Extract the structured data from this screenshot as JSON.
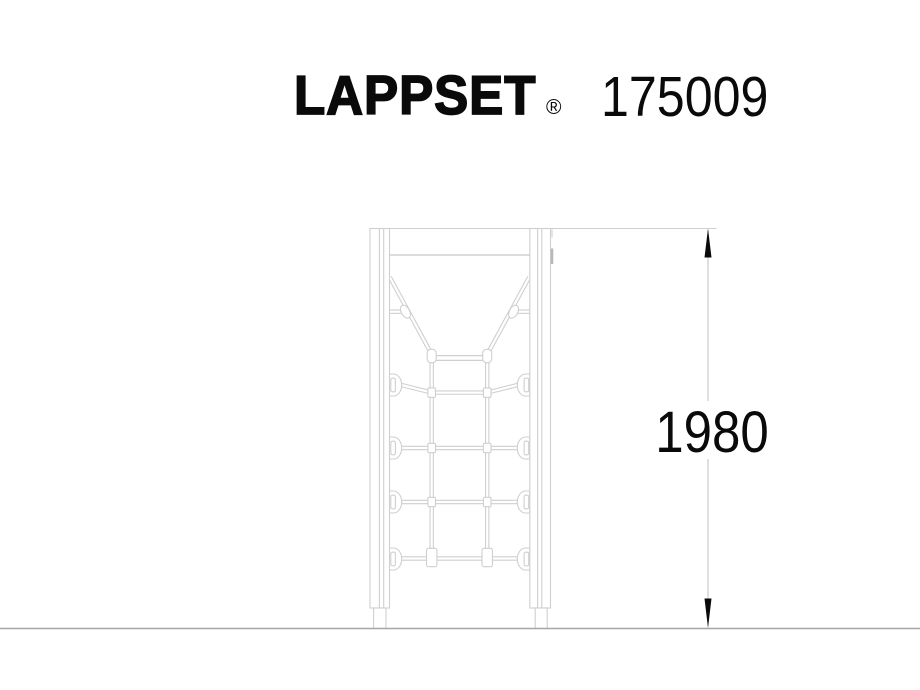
{
  "header": {
    "brand": "LAPPSET",
    "registered_mark": "®",
    "product_code": "175009"
  },
  "drawing": {
    "dimension": {
      "height_label": "1980"
    },
    "colors": {
      "background": "#ffffff",
      "ink": "#0a0a0a",
      "line": "#cfcfcf",
      "line-dark": "#b9b9b9",
      "ground": "#a6a6a6",
      "dim-line": "#c2c2c2"
    }
  }
}
